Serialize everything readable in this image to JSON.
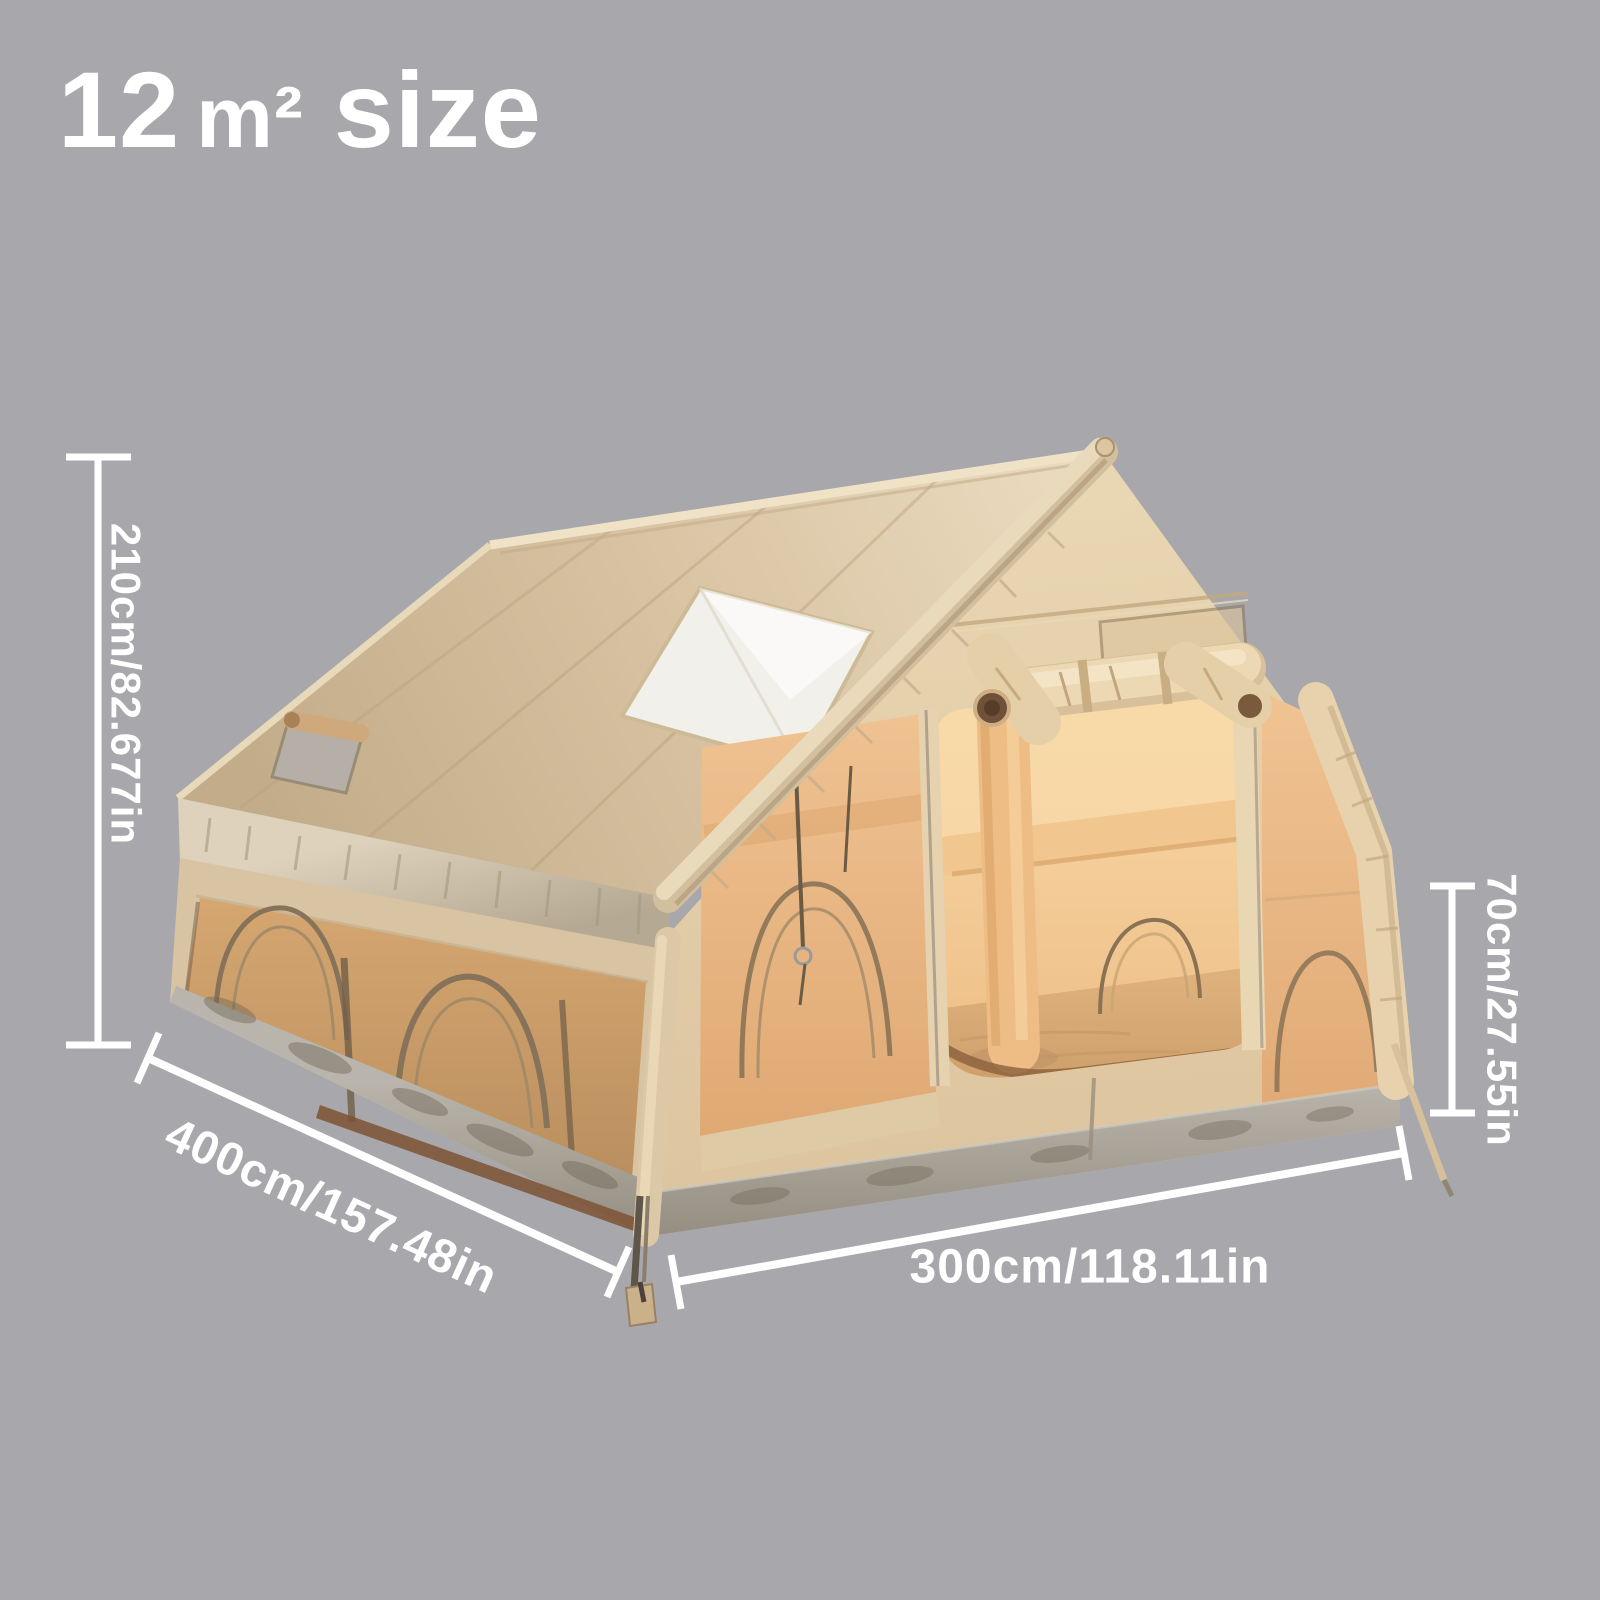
{
  "title": {
    "area_value": "12",
    "area_unit": "m²",
    "suffix": "size"
  },
  "dimensions": {
    "tent_height": {
      "label": "210cm/82.677in"
    },
    "tent_length": {
      "label": "400cm/157.48in"
    },
    "tent_width": {
      "label": "300cm/118.11in"
    },
    "wall_height": {
      "label": "70cm/27.55in"
    }
  },
  "colors": {
    "background": "#a8a8ac",
    "annotation": "#ffffff",
    "tent_beige": "#d8c3a3",
    "tent_mesh_orange": "#d2a36d",
    "interior_glow": "#f2c892",
    "skirt_gray": "#a29b8f"
  }
}
